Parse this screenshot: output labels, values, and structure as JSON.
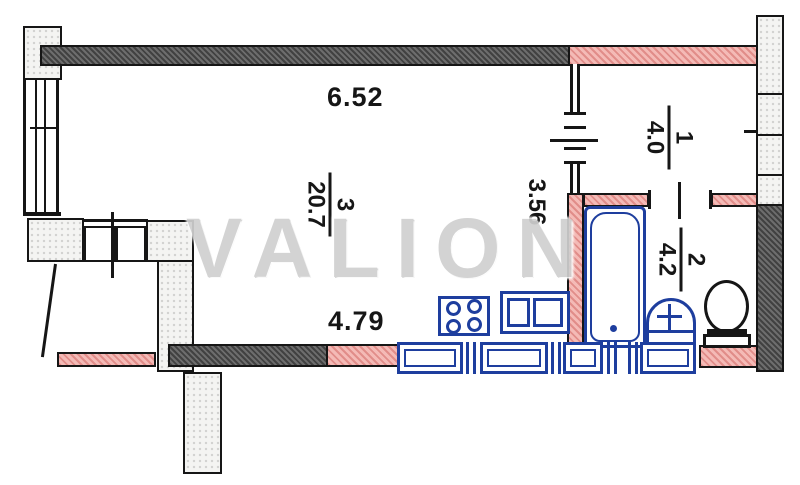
{
  "watermark": "VALION",
  "dimensions": {
    "top_wall": "6.52",
    "bottom_wall": "4.79",
    "hall_wall": "3.56"
  },
  "rooms": {
    "living": {
      "number": "3",
      "area": "20.7"
    },
    "hall": {
      "number": "1",
      "area": "4.0"
    },
    "bath": {
      "number": "2",
      "area": "4.2"
    }
  },
  "fixtures": {
    "stove": "four-burner-stove",
    "sink": "double-kitchen-sink",
    "counter": "kitchen-counter-run",
    "bathtub": "bathtub",
    "washbasin": "washbasin",
    "toilet": "toilet"
  },
  "colors": {
    "load_bearing_wall": "#646464",
    "partition_wall": "#f0a39e",
    "light_block": "#f4f4f2",
    "fixture_blue": "#1e3e9e",
    "line_black": "#161616",
    "watermark_gray": "#d0d0d0"
  }
}
